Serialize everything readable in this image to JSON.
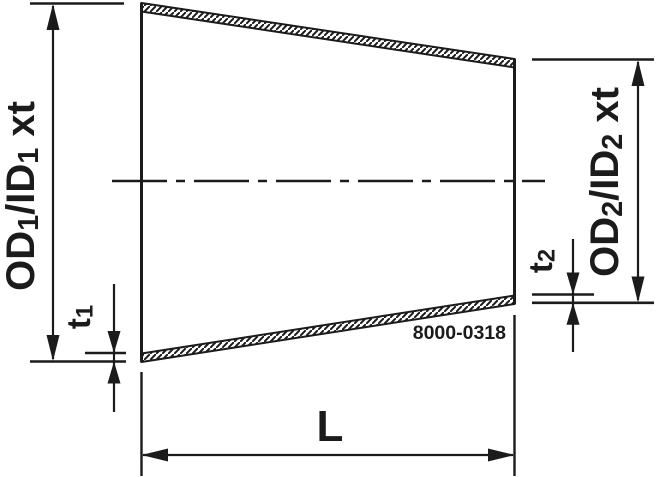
{
  "drawing": {
    "type": "technical-drawing",
    "description": "Concentric reducer fitting, cross-section with dimension callouts",
    "colors": {
      "background": "#ffffff",
      "ink": "#1b1b1b"
    },
    "labels": {
      "od1": "OD₁/ID₁ xt",
      "od2": "OD₂/ID₂ xt",
      "t1": "t₁",
      "t2": "t₂",
      "length": "L",
      "part_number": "8000-0318"
    }
  }
}
